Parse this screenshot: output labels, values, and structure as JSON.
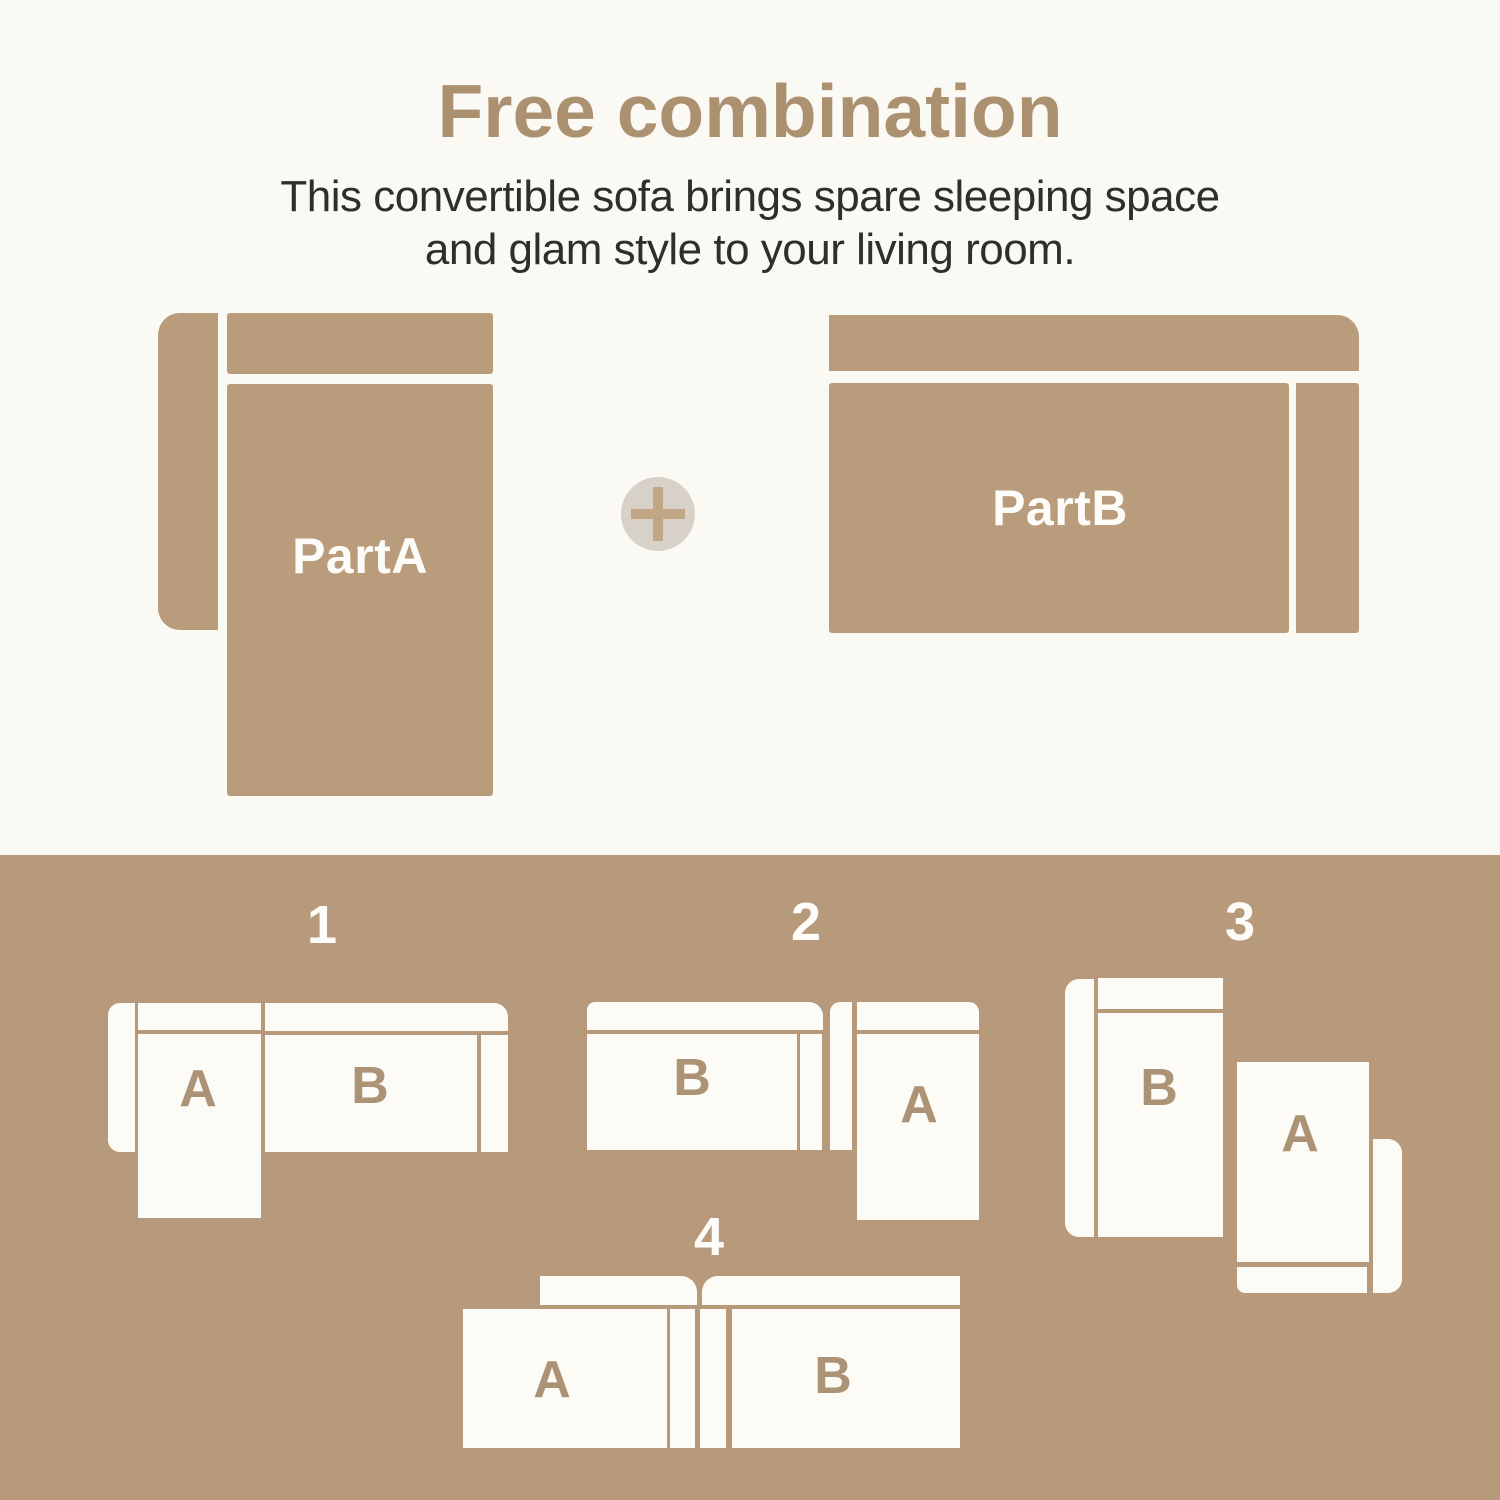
{
  "title": "Free combination",
  "subtitle": {
    "line1": "This convertible sofa brings spare sleeping space",
    "line2": "and glam style to your living room."
  },
  "parts": {
    "part_a": "PartA",
    "part_b": "PartB",
    "plus_symbol": "+"
  },
  "combinations": [
    {
      "number": "1",
      "left_piece": "A",
      "right_piece": "B"
    },
    {
      "number": "2",
      "left_piece": "B",
      "right_piece": "A"
    },
    {
      "number": "3",
      "left_piece": "B",
      "right_piece": "A"
    },
    {
      "number": "4",
      "left_piece": "A",
      "right_piece": "B"
    }
  ],
  "colors": {
    "background_cream": "#fbf9f4",
    "sofa_tan": "#b89c7c",
    "panel_tan": "#b69a7b",
    "title_tan": "#ac9170",
    "subtitle_gray": "#2e2e2e",
    "sofa_white": "#fcfbf5",
    "letter_tan": "#ad9376",
    "plus_circle_bg": "#d7d1c7",
    "plus_sign": "#c1a785"
  }
}
